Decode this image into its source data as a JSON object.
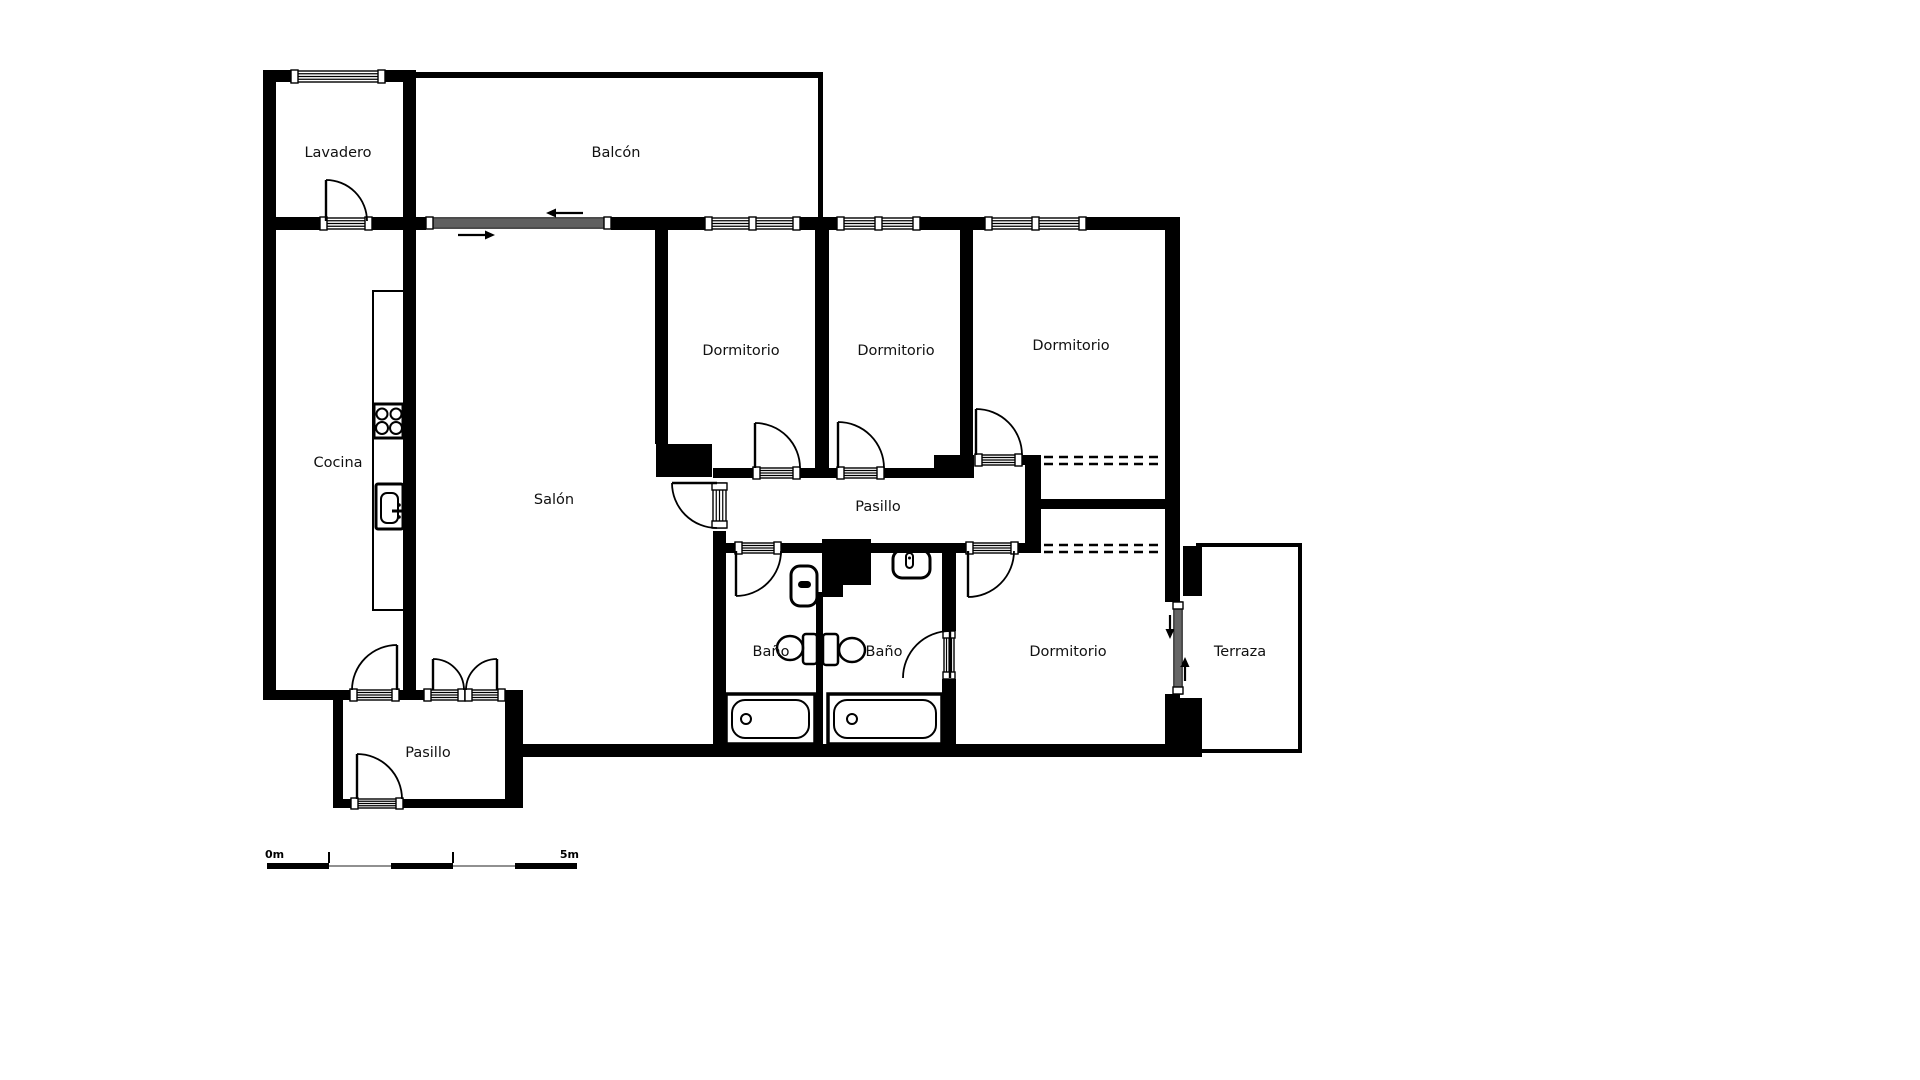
{
  "canvas": {
    "width": 1920,
    "height": 1080,
    "background": "#ffffff",
    "ink": "#000000",
    "text_color": "#111111",
    "label_font_size": 14.5
  },
  "room_labels": [
    {
      "id": "lavadero",
      "text": "Lavadero",
      "x": 338,
      "y": 157
    },
    {
      "id": "balcon",
      "text": "Balcón",
      "x": 616,
      "y": 157
    },
    {
      "id": "cocina",
      "text": "Cocina",
      "x": 338,
      "y": 467
    },
    {
      "id": "salon",
      "text": "Salón",
      "x": 554,
      "y": 504
    },
    {
      "id": "dormitorio-1",
      "text": "Dormitorio",
      "x": 741,
      "y": 355
    },
    {
      "id": "dormitorio-2",
      "text": "Dormitorio",
      "x": 896,
      "y": 355
    },
    {
      "id": "dormitorio-3",
      "text": "Dormitorio",
      "x": 1071,
      "y": 350
    },
    {
      "id": "pasillo-central",
      "text": "Pasillo",
      "x": 878,
      "y": 511
    },
    {
      "id": "bano-1",
      "text": "Baño",
      "x": 771,
      "y": 656
    },
    {
      "id": "bano-2",
      "text": "Baño",
      "x": 884,
      "y": 656
    },
    {
      "id": "dormitorio-4",
      "text": "Dormitorio",
      "x": 1068,
      "y": 656
    },
    {
      "id": "terraza",
      "text": "Terraza",
      "x": 1240,
      "y": 656
    },
    {
      "id": "pasillo-entrada",
      "text": "Pasillo",
      "x": 428,
      "y": 757
    }
  ],
  "scale_bar": {
    "zero_label": "0m",
    "end_label": "5m",
    "x": 267,
    "y": 863,
    "segment_length": 62,
    "segments": 5,
    "bar_height": 6,
    "thin_height": 2,
    "tick_height": 11,
    "ticks_at": [
      1,
      3
    ],
    "thin_color": "#909090",
    "label_font_size": 11
  },
  "floorplan": {
    "walls": [
      [
        263,
        70,
        13,
        630
      ],
      [
        263,
        70,
        28,
        12
      ],
      [
        385,
        70,
        31,
        12
      ],
      [
        403,
        70,
        13,
        620
      ],
      [
        416,
        72,
        402,
        6
      ],
      [
        818,
        72,
        5,
        151
      ],
      [
        263,
        217,
        57,
        13
      ],
      [
        372,
        217,
        44,
        13
      ],
      [
        416,
        217,
        10,
        13
      ],
      [
        611,
        217,
        94,
        13
      ],
      [
        800,
        217,
        37,
        13
      ],
      [
        920,
        217,
        65,
        13
      ],
      [
        1086,
        217,
        94,
        13
      ],
      [
        1165,
        222,
        15,
        380
      ],
      [
        1165,
        694,
        15,
        63
      ],
      [
        655,
        230,
        13,
        214
      ],
      [
        656,
        444,
        56,
        33
      ],
      [
        815,
        230,
        14,
        238
      ],
      [
        960,
        230,
        13,
        225
      ],
      [
        713,
        468,
        40,
        10
      ],
      [
        800,
        468,
        37,
        10
      ],
      [
        884,
        468,
        78,
        10
      ],
      [
        934,
        455,
        40,
        23
      ],
      [
        1022,
        455,
        19,
        10
      ],
      [
        1025,
        455,
        16,
        98
      ],
      [
        1035,
        499,
        141,
        10
      ],
      [
        713,
        531,
        13,
        213
      ],
      [
        713,
        543,
        22,
        10
      ],
      [
        781,
        543,
        41,
        10
      ],
      [
        871,
        543,
        95,
        10
      ],
      [
        1018,
        543,
        23,
        10
      ],
      [
        822,
        539,
        49,
        46
      ],
      [
        822,
        585,
        21,
        12
      ],
      [
        816,
        592,
        7,
        152
      ],
      [
        942,
        553,
        14,
        78
      ],
      [
        942,
        679,
        14,
        65
      ],
      [
        523,
        744,
        679,
        13
      ],
      [
        263,
        690,
        87,
        10
      ],
      [
        399,
        690,
        25,
        10
      ],
      [
        333,
        690,
        10,
        118
      ],
      [
        505,
        690,
        18,
        118
      ],
      [
        333,
        799,
        18,
        9
      ],
      [
        403,
        799,
        120,
        9
      ],
      [
        1183,
        546,
        19,
        50
      ],
      [
        1172,
        698,
        30,
        59
      ]
    ],
    "openings": [
      {
        "name": "lavadero-window",
        "x": 291,
        "y": 71,
        "w": 94,
        "h": 11,
        "o": "h",
        "n": 3,
        "caps": [
          0,
          1
        ]
      },
      {
        "name": "balcony-sliding-door",
        "x": 426,
        "y": 218,
        "w": 185,
        "h": 10,
        "o": "h",
        "n": 4,
        "caps": [
          0,
          1
        ]
      },
      {
        "name": "dormitorio1-window",
        "x": 705,
        "y": 218,
        "w": 95,
        "h": 11,
        "o": "h",
        "n": 3,
        "caps": [
          0,
          0.5,
          1
        ]
      },
      {
        "name": "dormitorio2-window",
        "x": 837,
        "y": 218,
        "w": 83,
        "h": 11,
        "o": "h",
        "n": 3,
        "caps": [
          0,
          0.5,
          1
        ]
      },
      {
        "name": "dormitorio3-window",
        "x": 985,
        "y": 218,
        "w": 101,
        "h": 11,
        "o": "h",
        "n": 3,
        "caps": [
          0,
          0.5,
          1
        ]
      },
      {
        "name": "terraza-sliding-door",
        "x": 1174,
        "y": 602,
        "w": 8,
        "h": 92,
        "o": "v",
        "n": 3,
        "caps": [
          0,
          1
        ]
      },
      {
        "name": "lavadero-door-threshold",
        "x": 320,
        "y": 218,
        "w": 52,
        "h": 11,
        "o": "h",
        "n": 3,
        "caps": [
          0,
          1
        ]
      },
      {
        "name": "dormitorio1-door-threshold",
        "x": 753,
        "y": 468,
        "w": 47,
        "h": 10,
        "o": "h",
        "n": 3,
        "caps": [
          0,
          1
        ]
      },
      {
        "name": "dormitorio2-door-threshold",
        "x": 837,
        "y": 468,
        "w": 47,
        "h": 10,
        "o": "h",
        "n": 3,
        "caps": [
          0,
          1
        ]
      },
      {
        "name": "dormitorio3-door-threshold",
        "x": 975,
        "y": 455,
        "w": 47,
        "h": 10,
        "o": "h",
        "n": 3,
        "caps": [
          0,
          1
        ]
      },
      {
        "name": "salon-door-threshold",
        "x": 713,
        "y": 483,
        "w": 13,
        "h": 45,
        "o": "v",
        "n": 3,
        "caps": [
          0,
          1
        ]
      },
      {
        "name": "bano1-door-threshold",
        "x": 735,
        "y": 543,
        "w": 46,
        "h": 10,
        "o": "h",
        "n": 3,
        "caps": [
          0,
          1
        ]
      },
      {
        "name": "dormitorio4-door-threshold",
        "x": 966,
        "y": 543,
        "w": 52,
        "h": 10,
        "o": "h",
        "n": 3,
        "caps": [
          0,
          1
        ]
      },
      {
        "name": "bano2-door-threshold",
        "x": 944,
        "y": 631,
        "w": 10,
        "h": 48,
        "o": "v",
        "n": 3,
        "caps": [
          0,
          1
        ]
      },
      {
        "name": "cocina-door-threshold",
        "x": 350,
        "y": 690,
        "w": 49,
        "h": 10,
        "o": "h",
        "n": 3,
        "caps": [
          0,
          1
        ]
      },
      {
        "name": "double-door-threshold-left",
        "x": 424,
        "y": 690,
        "w": 41,
        "h": 10,
        "o": "h",
        "n": 3,
        "caps": [
          0,
          1
        ]
      },
      {
        "name": "double-door-threshold-right",
        "x": 465,
        "y": 690,
        "w": 40,
        "h": 10,
        "o": "h",
        "n": 3,
        "caps": [
          0,
          1
        ]
      },
      {
        "name": "entrance-door-threshold",
        "x": 351,
        "y": 799,
        "w": 52,
        "h": 9,
        "o": "h",
        "n": 3,
        "caps": [
          0,
          1
        ]
      }
    ],
    "doors": [
      {
        "name": "lavadero-door",
        "cx": 326,
        "cy": 221,
        "r": 41,
        "a1": -90,
        "a2": 0,
        "sweep": 1
      },
      {
        "name": "dormitorio1-door",
        "cx": 755,
        "cy": 468,
        "r": 45,
        "a1": -90,
        "a2": 0,
        "sweep": 1
      },
      {
        "name": "dormitorio2-door",
        "cx": 838,
        "cy": 468,
        "r": 46,
        "a1": -90,
        "a2": 0,
        "sweep": 1
      },
      {
        "name": "dormitorio3-door",
        "cx": 976,
        "cy": 455,
        "r": 46,
        "a1": -90,
        "a2": 0,
        "sweep": 1
      },
      {
        "name": "salon-door",
        "cx": 717,
        "cy": 483,
        "r": 45,
        "a1": 180,
        "a2": 90,
        "sweep": 0
      },
      {
        "name": "bano1-door",
        "cx": 736,
        "cy": 551,
        "r": 45,
        "a1": 90,
        "a2": 0,
        "sweep": 0
      },
      {
        "name": "dormitorio4-door",
        "cx": 968,
        "cy": 551,
        "r": 46,
        "a1": 90,
        "a2": 0,
        "sweep": 0
      },
      {
        "name": "bano2-door",
        "cx": 950,
        "cy": 678,
        "r": 47,
        "a1": -90,
        "a2": 180,
        "sweep": 0
      },
      {
        "name": "cocina-door",
        "cx": 397,
        "cy": 690,
        "r": 45,
        "a1": -90,
        "a2": 180,
        "sweep": 0
      },
      {
        "name": "double-door-left-leaf",
        "cx": 433,
        "cy": 690,
        "r": 31,
        "a1": -90,
        "a2": 0,
        "sweep": 1
      },
      {
        "name": "double-door-right-leaf",
        "cx": 497,
        "cy": 690,
        "r": 31,
        "a1": -90,
        "a2": 180,
        "sweep": 0
      },
      {
        "name": "entrance-door",
        "cx": 357,
        "cy": 799,
        "r": 45,
        "a1": -90,
        "a2": 0,
        "sweep": 1
      }
    ],
    "arrows": [
      {
        "name": "balcony-slide-arrow-left",
        "x1": 583,
        "y1": 213,
        "x2": 546,
        "y2": 213
      },
      {
        "name": "balcony-slide-arrow-right",
        "x1": 458,
        "y1": 235,
        "x2": 495,
        "y2": 235
      },
      {
        "name": "terraza-slide-arrow-down",
        "x1": 1170,
        "y1": 615,
        "x2": 1170,
        "y2": 639
      },
      {
        "name": "terraza-slide-arrow-up",
        "x1": 1185,
        "y1": 681,
        "x2": 1185,
        "y2": 657
      }
    ],
    "dashed_lines": [
      {
        "name": "wardrobe-dorm3-front",
        "x1": 1044,
        "y1": 457,
        "x2": 1164,
        "y2": 457
      },
      {
        "name": "wardrobe-dorm3-front",
        "x1": 1044,
        "y1": 464,
        "x2": 1164,
        "y2": 464
      },
      {
        "name": "wardrobe-dorm4-front",
        "x1": 1044,
        "y1": 545,
        "x2": 1164,
        "y2": 545
      },
      {
        "name": "wardrobe-dorm4-front",
        "x1": 1044,
        "y1": 552,
        "x2": 1164,
        "y2": 552
      }
    ],
    "fixtures": [
      {
        "name": "kitchen-counter",
        "prims": [
          {
            "shape": "rect",
            "x": 373,
            "y": 291,
            "w": 31,
            "h": 319,
            "sw": 2
          }
        ]
      },
      {
        "name": "stove",
        "prims": [
          {
            "shape": "rect",
            "x": 374,
            "y": 404,
            "w": 29,
            "h": 34,
            "sw": 3
          },
          {
            "shape": "circle",
            "cx": 382,
            "cy": 414,
            "r": 5.5,
            "sw": 2
          },
          {
            "shape": "circle",
            "cx": 396,
            "cy": 414,
            "r": 5.5,
            "sw": 2
          },
          {
            "shape": "circle",
            "cx": 382,
            "cy": 428,
            "r": 6,
            "sw": 2
          },
          {
            "shape": "circle",
            "cx": 396,
            "cy": 428,
            "r": 6,
            "sw": 2
          }
        ]
      },
      {
        "name": "kitchen-sink",
        "prims": [
          {
            "shape": "rect",
            "x": 376,
            "y": 484,
            "w": 27,
            "h": 45,
            "rx": 2,
            "sw": 3
          },
          {
            "shape": "rect",
            "x": 381,
            "y": 493,
            "w": 17,
            "h": 30,
            "rx": 6,
            "sw": 2
          },
          {
            "shape": "line",
            "x1": 392,
            "y1": 511,
            "x2": 403,
            "y2": 511,
            "sw": 3
          },
          {
            "shape": "circle",
            "cx": 399,
            "cy": 505,
            "r": 1.8,
            "sw": 0,
            "fill": "#000000"
          },
          {
            "shape": "circle",
            "cx": 399,
            "cy": 517,
            "r": 1.8,
            "sw": 0,
            "fill": "#000000"
          }
        ]
      },
      {
        "name": "toilet-bano1",
        "prims": [
          {
            "shape": "rect",
            "x": 791,
            "y": 566,
            "w": 26,
            "h": 40,
            "rx": 9,
            "sw": 3
          },
          {
            "shape": "rect",
            "x": 798,
            "y": 581,
            "w": 13,
            "h": 7,
            "rx": 3.5,
            "sw": 0,
            "fill": "#000000"
          }
        ]
      },
      {
        "name": "toilet-bano2",
        "prims": [
          {
            "shape": "rect",
            "x": 893,
            "y": 550,
            "w": 37,
            "h": 28,
            "rx": 9,
            "sw": 3
          },
          {
            "shape": "rect",
            "x": 906,
            "y": 553,
            "w": 7,
            "h": 15,
            "rx": 3.5,
            "sw": 2
          },
          {
            "shape": "circle",
            "cx": 909.5,
            "cy": 558,
            "r": 1.5,
            "sw": 0,
            "fill": "#000000"
          }
        ]
      },
      {
        "name": "pedestal-sink-bano1",
        "prims": [
          {
            "shape": "rect",
            "x": 803,
            "y": 634,
            "w": 14,
            "h": 30,
            "rx": 3,
            "sw": 2.5
          },
          {
            "shape": "ellipse",
            "cx": 790,
            "cy": 648,
            "rx": 13,
            "ry": 12,
            "sw": 2.5
          }
        ]
      },
      {
        "name": "pedestal-sink-bano2",
        "prims": [
          {
            "shape": "rect",
            "x": 823,
            "y": 634,
            "w": 15,
            "h": 31,
            "rx": 3,
            "sw": 2.5
          },
          {
            "shape": "ellipse",
            "cx": 852,
            "cy": 650,
            "rx": 13,
            "ry": 12,
            "sw": 2.5
          }
        ]
      },
      {
        "name": "bathtub-bano1",
        "prims": [
          {
            "shape": "rect",
            "x": 726,
            "y": 694,
            "w": 89,
            "h": 50,
            "sw": 3.5
          },
          {
            "shape": "rect",
            "x": 732,
            "y": 700,
            "w": 77,
            "h": 38,
            "rx": 13,
            "sw": 2
          },
          {
            "shape": "circle",
            "cx": 746,
            "cy": 719,
            "r": 5,
            "sw": 2
          }
        ]
      },
      {
        "name": "bathtub-bano2",
        "prims": [
          {
            "shape": "rect",
            "x": 828,
            "y": 694,
            "w": 114,
            "h": 50,
            "sw": 3.5
          },
          {
            "shape": "rect",
            "x": 834,
            "y": 700,
            "w": 102,
            "h": 38,
            "rx": 13,
            "sw": 2
          },
          {
            "shape": "circle",
            "cx": 852,
            "cy": 719,
            "r": 5,
            "sw": 2
          }
        ]
      },
      {
        "name": "terraza-outline",
        "prims": [
          {
            "shape": "path",
            "d": "M 1196,545 L 1300,545 L 1300,751 L 1174,751",
            "sw": 4
          }
        ]
      }
    ]
  }
}
